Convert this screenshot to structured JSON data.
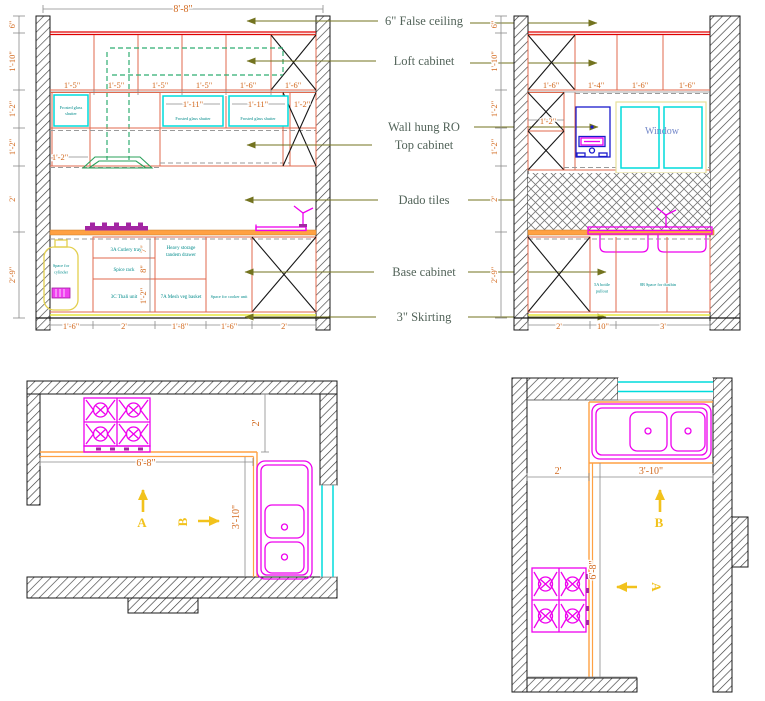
{
  "drawing_type": "Kitchen elevations and plan views",
  "colors": {
    "dimension_text": "#d2691e",
    "cabinet_lines": "#e0694e",
    "counter": "#ffa143",
    "false_ceiling_red": "#e00000",
    "loft_green": "#2fae72",
    "shutter_cyan": "#00dcdc",
    "unit_label_teal": "#008b8b",
    "annotation_text": "#53645a",
    "annotation_arrow": "#73731f",
    "fixture_magenta": "#ee00ee",
    "ro_blue": "#1a1acc",
    "cylinder_yellow": "#e3cf4e",
    "skirting_yellow": "#e6e63e",
    "section_arrow_gold": "#f2c21c",
    "window_text_blue": "#7287c9"
  },
  "annotations": {
    "false_ceiling": "6\" False ceiling",
    "loft_cabinet": "Loft cabinet",
    "wall_hung_ro": "Wall hung RO",
    "top_cabinet": "Top cabinet",
    "dado_tiles": "Dado tiles",
    "base_cabinet": "Base cabinet",
    "skirting": "3\" Skirting"
  },
  "elevation_a": {
    "overall_width": "8'-8\"",
    "left_dims": [
      "6\"",
      "1'-10\"",
      "1'-2\"",
      "1'-2\"",
      "2'",
      "2'-9\""
    ],
    "loft_dims": [
      "1'-5\"",
      "1'-5\"",
      "1'-5\"",
      "1'-5\"",
      "1'-6\"",
      "1'-6\""
    ],
    "shutter_dims": [
      "1'-11\"",
      "1'-11\"",
      "1'-2\""
    ],
    "shutter_label": "Frosted glass shutter",
    "shutter_label_lines": [
      "Frosted glass",
      "shutter"
    ],
    "row2_dim": "1'-2\"",
    "base_sub_dims": [
      "7\"",
      "8\"",
      "1'-2\""
    ],
    "base_units": [
      "3A Cutlery tray",
      "Spice rack",
      "3C Thali unit"
    ],
    "heavy_storage_lines": [
      "Heavy storage",
      "tandem drawer"
    ],
    "mesh_basket": "7A Mesh veg basket",
    "cooker_space": "Space for cooker unit",
    "cylinder_lines": [
      "Space for",
      "cylinder"
    ],
    "bottom_dims": [
      "1'-6\"",
      "2'",
      "1'-8\"",
      "1'-6\"",
      "2'"
    ]
  },
  "elevation_b": {
    "left_dims": [
      "6\"",
      "1'-10\"",
      "1'-2\"",
      "1'-2\"",
      "2'",
      "2'-9\""
    ],
    "loft_dims": [
      "1'-6\"",
      "1'-4\"",
      "1'-6\"",
      "1'-6\""
    ],
    "tall_unit_dim": "1'-2\"",
    "window_label": "Window",
    "bottle_pullout_lines": [
      "5A bottle",
      "pullout"
    ],
    "dustbin_space": "8B Space for dustbin",
    "bottom_dims": [
      "2'",
      "10\"",
      "3'"
    ]
  },
  "plan_a": {
    "counter_dim": "6'-8\"",
    "depth_dim": "3'-10\"",
    "top_dim": "2'",
    "section_a": "A",
    "section_b": "B"
  },
  "plan_b": {
    "left_dim": "2'",
    "sink_run_dim": "3'-10\"",
    "counter_run_dim": "6'-8\"",
    "section_a": "A",
    "section_b": "B"
  }
}
